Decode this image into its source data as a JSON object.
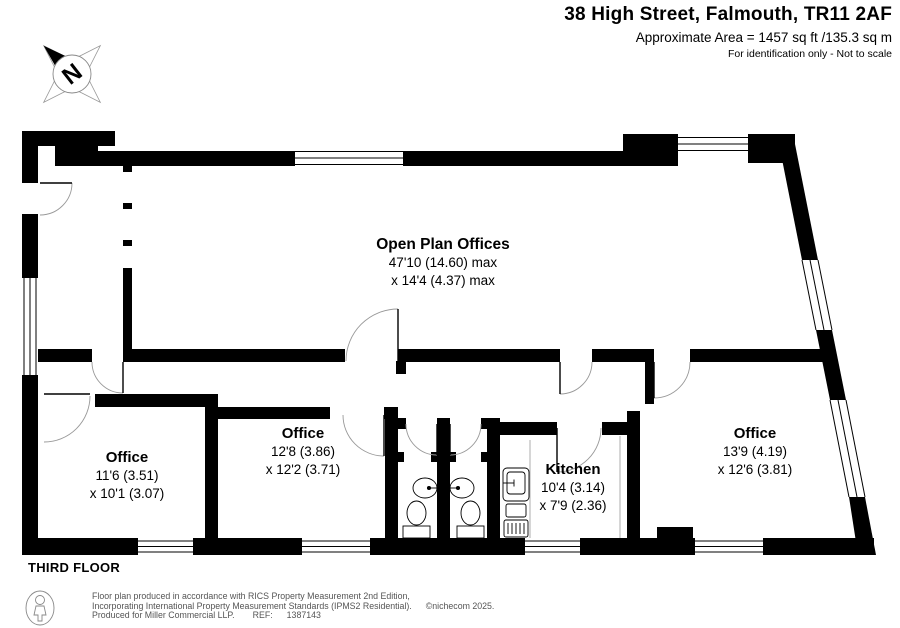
{
  "header": {
    "title": "38 High Street, Falmouth, TR11 2AF",
    "area": "Approximate Area = 1457 sq ft /135.3 sq m",
    "disclaimer": "For identification only - Not to scale"
  },
  "compass": {
    "north_label": "N"
  },
  "plan": {
    "floor_label": "THIRD FLOOR",
    "rooms": {
      "open_plan": {
        "name": "Open Plan Offices",
        "dim_line1": "47'10 (14.60) max",
        "dim_line2": "x 14'4 (4.37) max"
      },
      "office_left": {
        "name": "Office",
        "dim_line1": "11'6 (3.51)",
        "dim_line2": "x 10'1 (3.07)"
      },
      "office_middle": {
        "name": "Office",
        "dim_line1": "12'8 (3.86)",
        "dim_line2": "x 12'2 (3.71)"
      },
      "kitchen": {
        "name": "Kitchen",
        "dim_line1": "10'4 (3.14)",
        "dim_line2": "x 7'9 (2.36)"
      },
      "office_right": {
        "name": "Office",
        "dim_line1": "13'9 (4.19)",
        "dim_line2": "x 12'6 (3.81)"
      }
    }
  },
  "footer": {
    "line1": "Floor plan produced in accordance with RICS Property Measurement 2nd Edition,",
    "line2": "Incorporating International Property Measurement Standards (IPMS2 Residential).",
    "copyright": "©nichecom 2025.",
    "line3": "Produced for Miller Commercial LLP.",
    "ref_label": "REF:",
    "ref_value": "1387143"
  },
  "colors": {
    "wall": "#000000",
    "door_arc": "#999999",
    "background": "#ffffff"
  }
}
